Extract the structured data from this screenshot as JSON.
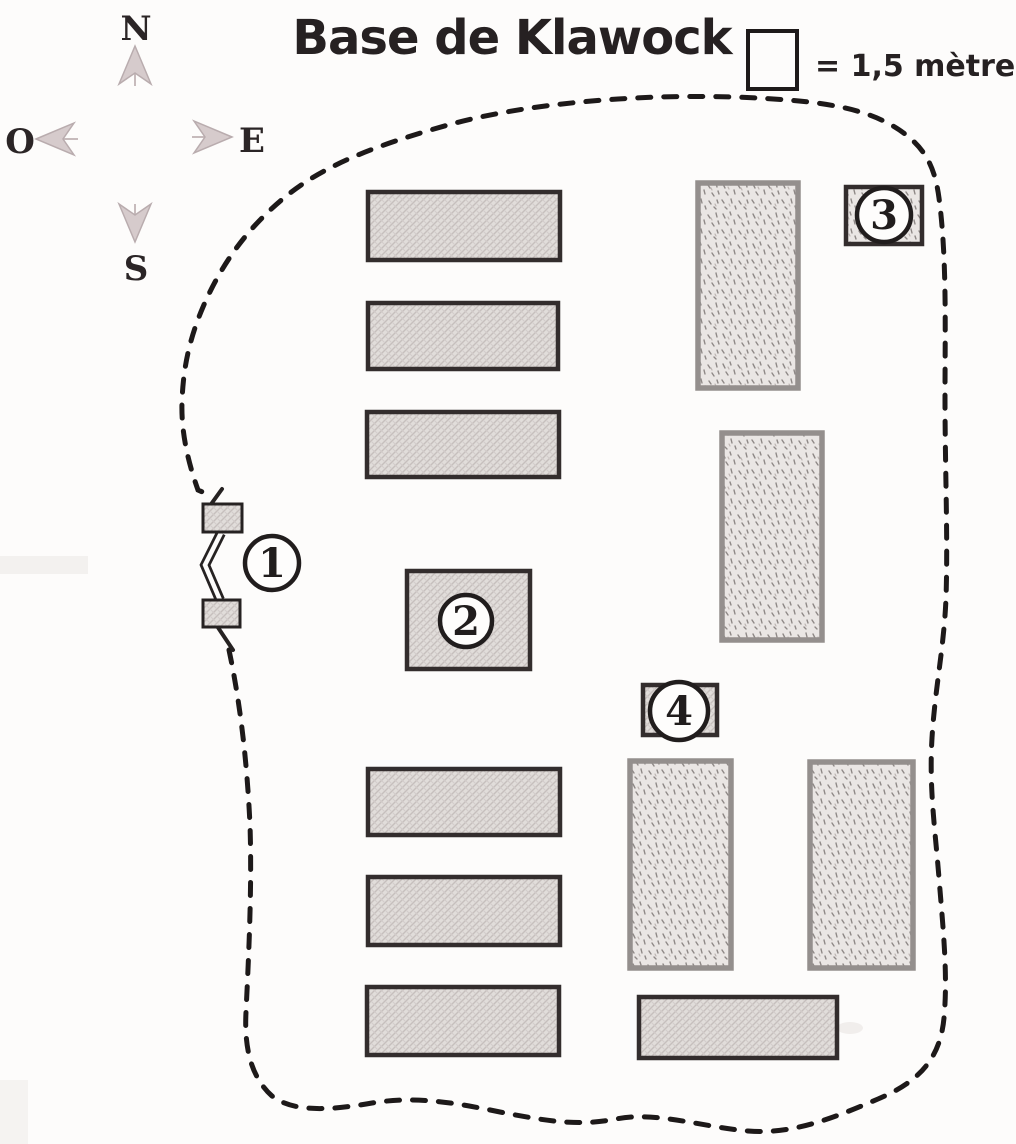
{
  "title": "Base de Klawock",
  "legend": {
    "label": "= 1,5 mètre"
  },
  "compass": {
    "north": "N",
    "east": "E",
    "south": "S",
    "west": "O"
  },
  "markers": [
    {
      "label": "1",
      "cx": 272,
      "cy": 563,
      "r": 27
    },
    {
      "label": "2",
      "cx": 466,
      "cy": 621,
      "r": 26
    },
    {
      "label": "3",
      "cx": 884,
      "cy": 215,
      "r": 27
    },
    {
      "label": "4",
      "cx": 679,
      "cy": 711,
      "r": 29
    }
  ],
  "map": {
    "buildings": [
      {
        "id": "barrack-nw-1",
        "x": 368,
        "y": 192,
        "w": 192,
        "h": 68,
        "fill": "hatch",
        "border": "dark"
      },
      {
        "id": "barrack-nw-2",
        "x": 368,
        "y": 303,
        "w": 190,
        "h": 66,
        "fill": "hatch",
        "border": "dark"
      },
      {
        "id": "barrack-nw-3",
        "x": 367,
        "y": 412,
        "w": 192,
        "h": 65,
        "fill": "hatch",
        "border": "dark"
      },
      {
        "id": "depot-ne",
        "x": 698,
        "y": 183,
        "w": 100,
        "h": 205,
        "fill": "stipple",
        "border": "gray"
      },
      {
        "id": "depot-e",
        "x": 722,
        "y": 433,
        "w": 100,
        "h": 207,
        "fill": "stipple",
        "border": "gray"
      },
      {
        "id": "building-2",
        "x": 407,
        "y": 571,
        "w": 123,
        "h": 98,
        "fill": "hatch",
        "border": "dark"
      },
      {
        "id": "barrack-sw-1",
        "x": 368,
        "y": 769,
        "w": 192,
        "h": 66,
        "fill": "hatch",
        "border": "dark"
      },
      {
        "id": "barrack-sw-2",
        "x": 368,
        "y": 877,
        "w": 192,
        "h": 68,
        "fill": "hatch",
        "border": "dark"
      },
      {
        "id": "barrack-sw-3",
        "x": 367,
        "y": 987,
        "w": 192,
        "h": 68,
        "fill": "hatch",
        "border": "dark"
      },
      {
        "id": "depot-se-1",
        "x": 630,
        "y": 761,
        "w": 101,
        "h": 207,
        "fill": "stipple",
        "border": "gray"
      },
      {
        "id": "depot-se-2",
        "x": 810,
        "y": 762,
        "w": 103,
        "h": 206,
        "fill": "stipple",
        "border": "gray"
      },
      {
        "id": "barrack-s",
        "x": 639,
        "y": 997,
        "w": 198,
        "h": 61,
        "fill": "hatch",
        "border": "dark"
      },
      {
        "id": "building-3",
        "x": 846,
        "y": 187,
        "w": 76,
        "h": 57,
        "fill": "stipple",
        "border": "dark"
      },
      {
        "id": "building-4",
        "x": 643,
        "y": 685,
        "w": 74,
        "h": 50,
        "fill": "hatch",
        "border": "dark"
      }
    ],
    "gate_posts": [
      {
        "x": 203,
        "y": 504,
        "w": 39,
        "h": 28
      },
      {
        "x": 203,
        "y": 600,
        "w": 37,
        "h": 27
      }
    ]
  },
  "colors": {
    "ink": "#262122",
    "hatch_fill": "#e1ddda",
    "stipple_fill": "#eae6e4",
    "dark_border": "#332d2d",
    "gray_border": "#948f8d",
    "compass_arrow": "#d6cbcc",
    "paper": "#fdfcfb"
  }
}
